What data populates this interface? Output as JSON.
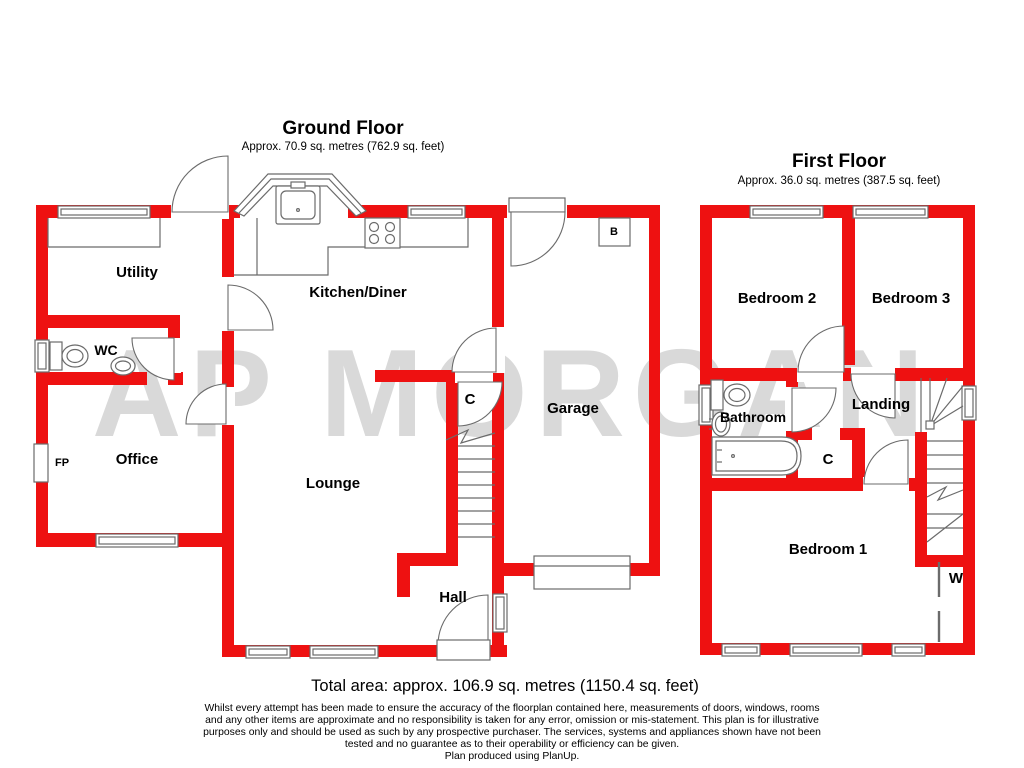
{
  "watermark": "AP MORGAN",
  "ground_floor": {
    "title": "Ground Floor",
    "subtitle": "Approx. 70.9 sq. metres (762.9 sq. feet)",
    "rooms": {
      "utility": "Utility",
      "wc": "WC",
      "office": "Office",
      "fireplace": "FP",
      "kitchen_diner": "Kitchen/Diner",
      "lounge": "Lounge",
      "cupboard": "C",
      "garage": "Garage",
      "hall": "Hall",
      "boiler": "B"
    }
  },
  "first_floor": {
    "title": "First Floor",
    "subtitle": "Approx. 36.0 sq. metres (387.5 sq. feet)",
    "rooms": {
      "bedroom1": "Bedroom 1",
      "bedroom2": "Bedroom 2",
      "bedroom3": "Bedroom 3",
      "bathroom": "Bathroom",
      "landing": "Landing",
      "cupboard": "C",
      "wardrobe": "W"
    }
  },
  "footer": {
    "total_area": "Total area: approx. 106.9 sq. metres (1150.4 sq. feet)",
    "disclaimer_lines": [
      "Whilst every attempt has been made to ensure the accuracy of the floorplan contained here, measurements of doors, windows, rooms",
      "and any other items are approximate and no responsibility is taken for any error, omission or mis-statement. This plan is for illustrative",
      "purposes only and should be used as such by any prospective purchaser. The services, systems and appliances shown have not been",
      "tested and no guarantee as to their operability or efficiency can be given."
    ],
    "produced": "Plan produced using PlanUp."
  },
  "colors": {
    "wall": "#ee1111",
    "outline": "#6b6b6b",
    "watermark": "#d9d9d9",
    "label": "#000000"
  }
}
